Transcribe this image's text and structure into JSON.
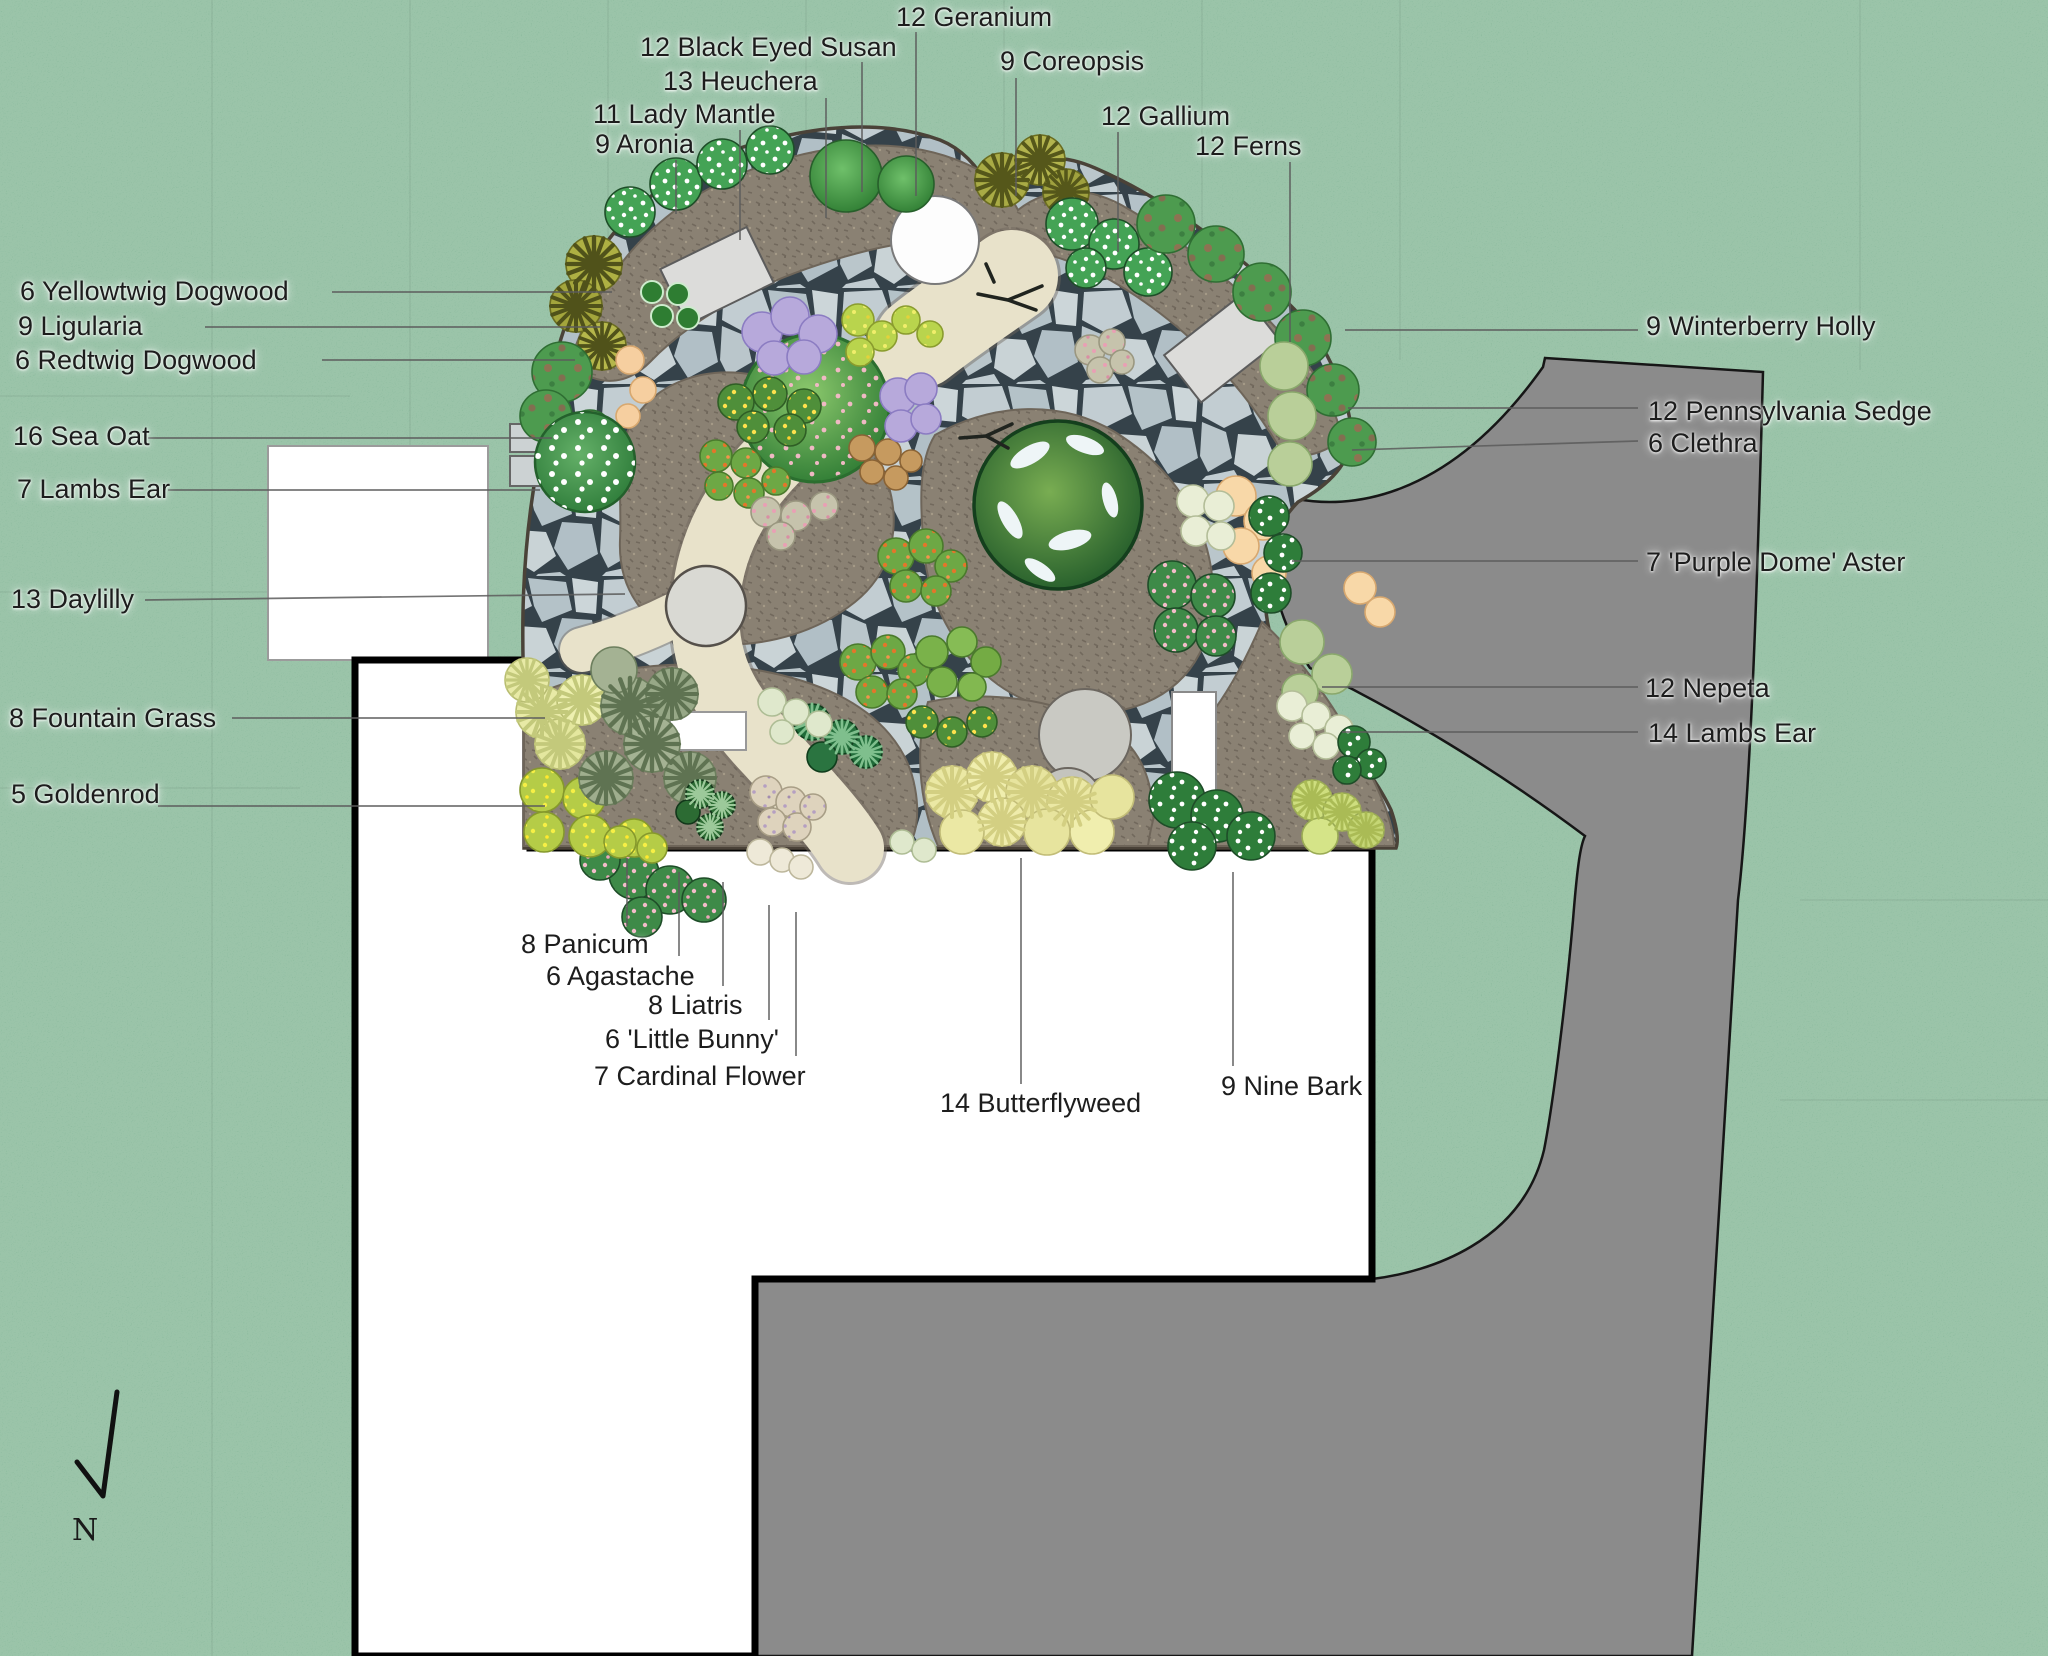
{
  "plan": {
    "type": "landscape-planting-plan",
    "compass": {
      "label": "N"
    },
    "labels": {
      "geranium": "12 Geranium",
      "black_eyed_susan": "12 Black Eyed Susan",
      "heuchera": "13 Heuchera",
      "lady_mantle": "11 Lady Mantle",
      "aronia": "9 Aronia",
      "coreopsis": "9 Coreopsis",
      "gallium": "12 Gallium",
      "ferns": "12 Ferns",
      "yellowtwig_dogwood": "6 Yellowtwig Dogwood",
      "ligularia": "9 Ligularia",
      "redtwig_dogwood": "6 Redtwig Dogwood",
      "sea_oat": "16 Sea Oat",
      "lambs_ear_7": "7 Lambs Ear",
      "daylilly": "13 Daylilly",
      "fountain_grass": "8 Fountain Grass",
      "goldenrod": "5 Goldenrod",
      "winterberry_holly": "9 Winterberry Holly",
      "pennsylvania_sedge": "12 Pennsylvania Sedge",
      "clethra": "6 Clethra",
      "purple_dome_aster": "7 'Purple Dome' Aster",
      "nepeta": "12 Nepeta",
      "lambs_ear_14": "14 Lambs Ear",
      "panicum": "8 Panicum",
      "agastache": "6 Agastache",
      "liatris": "8 Liatris",
      "little_bunny": "6 'Little Bunny'",
      "cardinal_flower": "7 Cardinal Flower",
      "butterflyweed": "14 Butterflyweed",
      "nine_bark": "9 Nine Bark"
    },
    "colors": {
      "lawn": "#79b08d",
      "driveway": "#8b8b8b",
      "house": "#ffffff",
      "soil": "#8a8173",
      "flagstone": "#c2cdd2",
      "gravel_path": "#e8e2ca"
    }
  }
}
